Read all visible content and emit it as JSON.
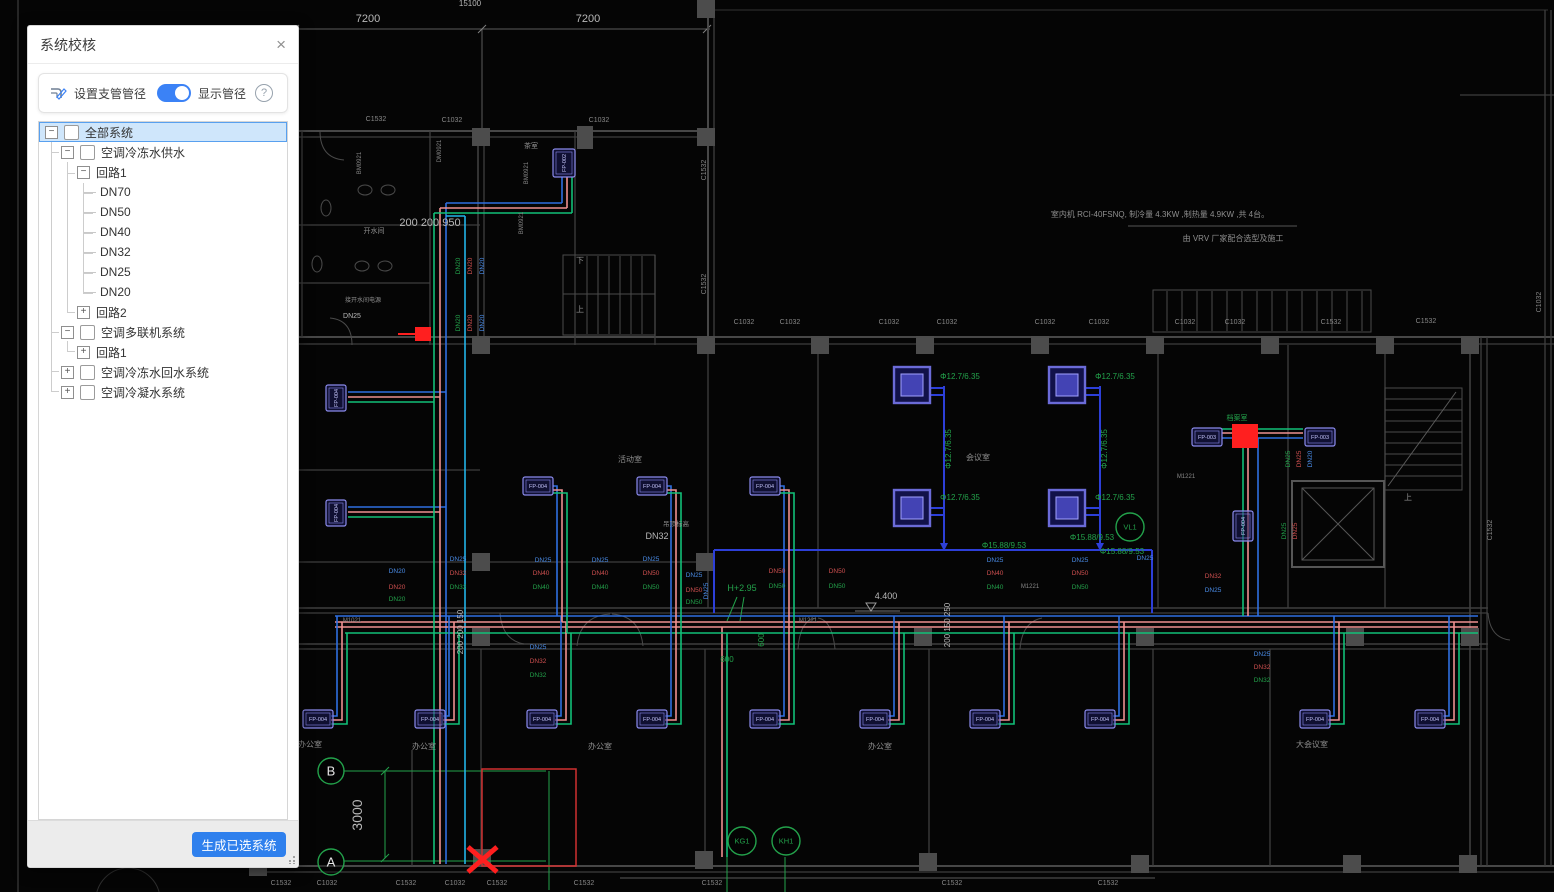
{
  "panel": {
    "title": "系统校核",
    "close_icon": "×",
    "toolbar": {
      "set_branch_icon": "pipe-pencil-icon",
      "set_branch_label": "设置支管管径",
      "toggle_on": true,
      "show_diameter_label": "显示管径",
      "help_icon": "?"
    },
    "tree": [
      {
        "label": "全部系统",
        "level": 0,
        "exp": "minus",
        "checkbox": true,
        "selected": true
      },
      {
        "label": "空调冷冻水供水",
        "level": 1,
        "exp": "minus",
        "checkbox": true
      },
      {
        "label": "回路1",
        "level": 2,
        "exp": "minus",
        "checkbox": false
      },
      {
        "label": "DN70",
        "level": 3
      },
      {
        "label": "DN50",
        "level": 3
      },
      {
        "label": "DN40",
        "level": 3
      },
      {
        "label": "DN32",
        "level": 3
      },
      {
        "label": "DN25",
        "level": 3
      },
      {
        "label": "DN20",
        "level": 3
      },
      {
        "label": "回路2",
        "level": 2,
        "exp": "plus",
        "checkbox": false
      },
      {
        "label": "空调多联机系统",
        "level": 1,
        "exp": "minus",
        "checkbox": true
      },
      {
        "label": "回路1",
        "level": 2,
        "exp": "plus",
        "checkbox": false
      },
      {
        "label": "空调冷冻水回水系统",
        "level": 1,
        "exp": "plus",
        "checkbox": true
      },
      {
        "label": "空调冷凝水系统",
        "level": 1,
        "exp": "plus",
        "checkbox": true
      }
    ],
    "generate_button": "生成已选系统"
  },
  "canvas": {
    "colors": {
      "dim": "#b8b8b8",
      "room": "#8f8f8f",
      "grid": "#878787",
      "grn": "#23a24b",
      "b": "#4a8ce8",
      "r": "#cf5050",
      "g": "#23a24b",
      "unit": "#8b8bec",
      "red": "#ff2020",
      "pipe_blue": "#2f6fe0",
      "pipe_cyan": "#22b3e8",
      "pipe_pink": "#ef9191",
      "pipe_green": "#12c078",
      "pipe_vrv": "#2d3fd8"
    },
    "labels": [
      {
        "t": "7200",
        "x": 368,
        "y": 22,
        "c": "dim",
        "s": 11
      },
      {
        "t": "7200",
        "x": 588,
        "y": 22,
        "c": "dim",
        "s": 11
      },
      {
        "t": "15100",
        "x": 470,
        "y": 6,
        "c": "dim",
        "s": 8
      },
      {
        "t": "3000",
        "x": 362,
        "y": 815,
        "c": "dim",
        "s": 14,
        "r": -90
      },
      {
        "t": "200 200 950",
        "x": 430,
        "y": 226,
        "c": "dim",
        "s": 11
      },
      {
        "t": "200 200 150",
        "x": 463,
        "y": 632,
        "c": "dim",
        "s": 8,
        "r": -90
      },
      {
        "t": "200 150 250",
        "x": 950,
        "y": 625,
        "c": "dim",
        "s": 8,
        "r": -90
      },
      {
        "t": "4.400",
        "x": 886,
        "y": 599,
        "c": "dim",
        "s": 9
      },
      {
        "t": "DN32",
        "x": 657,
        "y": 539,
        "c": "dim",
        "s": 9
      },
      {
        "t": "DN25",
        "x": 352,
        "y": 318,
        "c": "dim",
        "s": 7
      },
      {
        "t": "H+2.95",
        "x": 742,
        "y": 591,
        "c": "grn",
        "s": 9
      },
      {
        "t": "600",
        "x": 764,
        "y": 640,
        "c": "grn",
        "s": 8,
        "r": -90
      },
      {
        "t": "600",
        "x": 727,
        "y": 662,
        "c": "grn",
        "s": 8
      },
      {
        "t": "Φ12.7/6.35",
        "x": 960,
        "y": 379,
        "c": "grn",
        "s": 8
      },
      {
        "t": "Φ12.7/6.35",
        "x": 1115,
        "y": 379,
        "c": "grn",
        "s": 8
      },
      {
        "t": "Φ12.7/6.35",
        "x": 951,
        "y": 449,
        "c": "grn",
        "s": 8,
        "r": -90
      },
      {
        "t": "Φ12.7/6.35",
        "x": 1107,
        "y": 449,
        "c": "grn",
        "s": 8,
        "r": -90
      },
      {
        "t": "Φ12.7/6.35",
        "x": 960,
        "y": 500,
        "c": "grn",
        "s": 8
      },
      {
        "t": "Φ12.7/6.35",
        "x": 1115,
        "y": 500,
        "c": "grn",
        "s": 8
      },
      {
        "t": "Φ15.88/9.53",
        "x": 1004,
        "y": 548,
        "c": "grn",
        "s": 8
      },
      {
        "t": "Φ15.88/9.53",
        "x": 1092,
        "y": 540,
        "c": "grn",
        "s": 8
      },
      {
        "t": "Φ15.88/9.53",
        "x": 1122,
        "y": 554,
        "c": "grn",
        "s": 8
      },
      {
        "t": "室内机 RCI-40FSNQ,   制冷量 4.3KW   ,制热量 4.9KW   ,共 4台。",
        "x": 1160,
        "y": 217,
        "c": "room",
        "s": 8
      },
      {
        "t": "由 VRV  厂家配合选型及施工",
        "x": 1233,
        "y": 241,
        "c": "room",
        "s": 8
      },
      {
        "t": "办公室",
        "x": 310,
        "y": 747,
        "c": "room",
        "s": 8
      },
      {
        "t": "办公室",
        "x": 424,
        "y": 749,
        "c": "room",
        "s": 8
      },
      {
        "t": "办公室",
        "x": 600,
        "y": 749,
        "c": "room",
        "s": 8
      },
      {
        "t": "办公室",
        "x": 880,
        "y": 749,
        "c": "room",
        "s": 8
      },
      {
        "t": "大会议室",
        "x": 1312,
        "y": 747,
        "c": "room",
        "s": 8
      },
      {
        "t": "活动室",
        "x": 630,
        "y": 462,
        "c": "room",
        "s": 8
      },
      {
        "t": "会议室",
        "x": 978,
        "y": 460,
        "c": "room",
        "s": 8
      },
      {
        "t": "档案室",
        "x": 1237,
        "y": 420,
        "c": "grn",
        "s": 7
      },
      {
        "t": "开水间",
        "x": 374,
        "y": 233,
        "c": "room",
        "s": 7
      },
      {
        "t": "茶室",
        "x": 531,
        "y": 148,
        "c": "room",
        "s": 7
      },
      {
        "t": "接开水间电源",
        "x": 363,
        "y": 302,
        "c": "room",
        "s": 6
      },
      {
        "t": "吊顶标高",
        "x": 676,
        "y": 526,
        "c": "room",
        "s": 6.5
      },
      {
        "t": "上",
        "x": 580,
        "y": 312,
        "c": "room",
        "s": 8
      },
      {
        "t": "下",
        "x": 580,
        "y": 263,
        "c": "room",
        "s": 8
      },
      {
        "t": "上",
        "x": 1408,
        "y": 500,
        "c": "room",
        "s": 8
      },
      {
        "t": "C1532",
        "x": 376,
        "y": 121,
        "c": "grid",
        "s": 7
      },
      {
        "t": "C1032",
        "x": 452,
        "y": 122,
        "c": "grid",
        "s": 7
      },
      {
        "t": "C1032",
        "x": 599,
        "y": 122,
        "c": "grid",
        "s": 7
      },
      {
        "t": "C1032",
        "x": 744,
        "y": 324,
        "c": "grid",
        "s": 7
      },
      {
        "t": "C1032",
        "x": 790,
        "y": 324,
        "c": "grid",
        "s": 7
      },
      {
        "t": "C1032",
        "x": 889,
        "y": 324,
        "c": "grid",
        "s": 7
      },
      {
        "t": "C1032",
        "x": 947,
        "y": 324,
        "c": "grid",
        "s": 7
      },
      {
        "t": "C1032",
        "x": 1045,
        "y": 324,
        "c": "grid",
        "s": 7
      },
      {
        "t": "C1032",
        "x": 1099,
        "y": 324,
        "c": "grid",
        "s": 7
      },
      {
        "t": "C1032",
        "x": 1185,
        "y": 324,
        "c": "grid",
        "s": 7
      },
      {
        "t": "C1032",
        "x": 1235,
        "y": 324,
        "c": "grid",
        "s": 7
      },
      {
        "t": "C1532",
        "x": 1331,
        "y": 324,
        "c": "grid",
        "s": 7
      },
      {
        "t": "C1532",
        "x": 1426,
        "y": 323,
        "c": "grid",
        "s": 7
      },
      {
        "t": "C1532",
        "x": 281,
        "y": 885,
        "c": "grid",
        "s": 7
      },
      {
        "t": "C1032",
        "x": 327,
        "y": 885,
        "c": "grid",
        "s": 7
      },
      {
        "t": "C1532",
        "x": 406,
        "y": 885,
        "c": "grid",
        "s": 7
      },
      {
        "t": "C1032",
        "x": 455,
        "y": 885,
        "c": "grid",
        "s": 7
      },
      {
        "t": "C1532",
        "x": 497,
        "y": 885,
        "c": "grid",
        "s": 7
      },
      {
        "t": "C1532",
        "x": 584,
        "y": 885,
        "c": "grid",
        "s": 7
      },
      {
        "t": "C1532",
        "x": 712,
        "y": 885,
        "c": "grid",
        "s": 7
      },
      {
        "t": "C1532",
        "x": 952,
        "y": 885,
        "c": "grid",
        "s": 7
      },
      {
        "t": "C1532",
        "x": 1108,
        "y": 885,
        "c": "grid",
        "s": 7
      },
      {
        "t": "C1532",
        "x": 706,
        "y": 170,
        "c": "grid",
        "s": 7,
        "r": -90
      },
      {
        "t": "C1532",
        "x": 706,
        "y": 284,
        "c": "grid",
        "s": 7,
        "r": -90
      },
      {
        "t": "C1532",
        "x": 1492,
        "y": 530,
        "c": "grid",
        "s": 7,
        "r": -90
      },
      {
        "t": "C1032",
        "x": 1541,
        "y": 302,
        "c": "grid",
        "s": 7,
        "r": -90
      },
      {
        "t": "BM0921",
        "x": 361,
        "y": 163,
        "c": "grid",
        "s": 6,
        "r": -90
      },
      {
        "t": "DM0921",
        "x": 441,
        "y": 151,
        "c": "grid",
        "s": 6,
        "r": -90
      },
      {
        "t": "BM0921",
        "x": 528,
        "y": 173,
        "c": "grid",
        "s": 6,
        "r": -90
      },
      {
        "t": "BM0921",
        "x": 523,
        "y": 223,
        "c": "grid",
        "s": 6,
        "r": -90
      },
      {
        "t": "M1021",
        "x": 352,
        "y": 622,
        "c": "grid",
        "s": 6
      },
      {
        "t": "M1221",
        "x": 808,
        "y": 622,
        "c": "grid",
        "s": 6
      },
      {
        "t": "M1221",
        "x": 1030,
        "y": 588,
        "c": "grid",
        "s": 6
      },
      {
        "t": "M1221",
        "x": 1186,
        "y": 478,
        "c": "grid",
        "s": 6
      },
      {
        "t": "DN20",
        "x": 397,
        "y": 573,
        "c": "b",
        "s": 6.5
      },
      {
        "t": "DN20",
        "x": 397,
        "y": 589,
        "c": "r",
        "s": 6.5
      },
      {
        "t": "DN20",
        "x": 397,
        "y": 601,
        "c": "g",
        "s": 6.5
      },
      {
        "t": "DN25",
        "x": 458,
        "y": 561,
        "c": "b",
        "s": 6.5
      },
      {
        "t": "DN32",
        "x": 458,
        "y": 575,
        "c": "r",
        "s": 6.5
      },
      {
        "t": "DN32",
        "x": 458,
        "y": 589,
        "c": "g",
        "s": 6.5
      },
      {
        "t": "DN25",
        "x": 543,
        "y": 562,
        "c": "b",
        "s": 6.5
      },
      {
        "t": "DN40",
        "x": 541,
        "y": 575,
        "c": "r",
        "s": 6.5
      },
      {
        "t": "DN40",
        "x": 541,
        "y": 589,
        "c": "g",
        "s": 6.5
      },
      {
        "t": "DN25",
        "x": 600,
        "y": 562,
        "c": "b",
        "s": 6.5
      },
      {
        "t": "DN40",
        "x": 600,
        "y": 575,
        "c": "r",
        "s": 6.5
      },
      {
        "t": "DN40",
        "x": 600,
        "y": 589,
        "c": "g",
        "s": 6.5
      },
      {
        "t": "DN25",
        "x": 651,
        "y": 561,
        "c": "b",
        "s": 6.5
      },
      {
        "t": "DN50",
        "x": 651,
        "y": 575,
        "c": "r",
        "s": 6.5
      },
      {
        "t": "DN50",
        "x": 651,
        "y": 589,
        "c": "g",
        "s": 6.5
      },
      {
        "t": "DN25",
        "x": 694,
        "y": 577,
        "c": "b",
        "s": 6.5
      },
      {
        "t": "DN50",
        "x": 694,
        "y": 592,
        "c": "r",
        "s": 6.5
      },
      {
        "t": "DN50",
        "x": 694,
        "y": 604,
        "c": "g",
        "s": 6.5
      },
      {
        "t": "DN50",
        "x": 777,
        "y": 573,
        "c": "r",
        "s": 6.5
      },
      {
        "t": "DN50",
        "x": 777,
        "y": 588,
        "c": "g",
        "s": 6.5
      },
      {
        "t": "DN50",
        "x": 837,
        "y": 573,
        "c": "r",
        "s": 6.5
      },
      {
        "t": "DN50",
        "x": 837,
        "y": 588,
        "c": "g",
        "s": 6.5
      },
      {
        "t": "DN25",
        "x": 995,
        "y": 562,
        "c": "b",
        "s": 6.5
      },
      {
        "t": "DN40",
        "x": 995,
        "y": 575,
        "c": "r",
        "s": 6.5
      },
      {
        "t": "DN40",
        "x": 995,
        "y": 589,
        "c": "g",
        "s": 6.5
      },
      {
        "t": "DN25",
        "x": 1080,
        "y": 562,
        "c": "b",
        "s": 6.5
      },
      {
        "t": "DN50",
        "x": 1080,
        "y": 575,
        "c": "r",
        "s": 6.5
      },
      {
        "t": "DN50",
        "x": 1080,
        "y": 589,
        "c": "g",
        "s": 6.5
      },
      {
        "t": "DN25",
        "x": 1145,
        "y": 560,
        "c": "b",
        "s": 6.5
      },
      {
        "t": "DN32",
        "x": 1213,
        "y": 578,
        "c": "r",
        "s": 6.5
      },
      {
        "t": "DN25",
        "x": 1213,
        "y": 592,
        "c": "b",
        "s": 6.5
      },
      {
        "t": "DN25",
        "x": 538,
        "y": 649,
        "c": "b",
        "s": 6.5
      },
      {
        "t": "DN32",
        "x": 538,
        "y": 663,
        "c": "r",
        "s": 6.5
      },
      {
        "t": "DN32",
        "x": 538,
        "y": 677,
        "c": "g",
        "s": 6.5
      },
      {
        "t": "DN25",
        "x": 1262,
        "y": 656,
        "c": "b",
        "s": 6.5
      },
      {
        "t": "DN32",
        "x": 1262,
        "y": 669,
        "c": "r",
        "s": 6.5
      },
      {
        "t": "DN32",
        "x": 1262,
        "y": 682,
        "c": "g",
        "s": 6.5
      },
      {
        "t": "DN20",
        "x": 460,
        "y": 266,
        "c": "g",
        "s": 6.5,
        "r": -90
      },
      {
        "t": "DN20",
        "x": 472,
        "y": 266,
        "c": "r",
        "s": 6.5,
        "r": -90
      },
      {
        "t": "DN20",
        "x": 484,
        "y": 266,
        "c": "b",
        "s": 6.5,
        "r": -90
      },
      {
        "t": "DN20",
        "x": 460,
        "y": 323,
        "c": "g",
        "s": 6.5,
        "r": -90
      },
      {
        "t": "DN20",
        "x": 472,
        "y": 323,
        "c": "r",
        "s": 6.5,
        "r": -90
      },
      {
        "t": "DN20",
        "x": 484,
        "y": 323,
        "c": "b",
        "s": 6.5,
        "r": -90
      },
      {
        "t": "DN25",
        "x": 1290,
        "y": 459,
        "c": "g",
        "s": 6.5,
        "r": -90
      },
      {
        "t": "DN25",
        "x": 1301,
        "y": 459,
        "c": "r",
        "s": 6.5,
        "r": -90
      },
      {
        "t": "DN20",
        "x": 1312,
        "y": 459,
        "c": "b",
        "s": 6.5,
        "r": -90
      },
      {
        "t": "DN25",
        "x": 1286,
        "y": 531,
        "c": "g",
        "s": 6.5,
        "r": -90
      },
      {
        "t": "DN25",
        "x": 1297,
        "y": 531,
        "c": "r",
        "s": 6.5,
        "r": -90
      },
      {
        "t": "DN25",
        "x": 708,
        "y": 591,
        "c": "b",
        "s": 6.5,
        "r": -90
      }
    ],
    "units": [
      {
        "label": "FP-004",
        "x": 303,
        "y": 710,
        "w": 30,
        "h": 18
      },
      {
        "label": "FP-004",
        "x": 415,
        "y": 710,
        "w": 30,
        "h": 18
      },
      {
        "label": "FP-004",
        "x": 527,
        "y": 710,
        "w": 30,
        "h": 18
      },
      {
        "label": "FP-004",
        "x": 637,
        "y": 710,
        "w": 30,
        "h": 18
      },
      {
        "label": "FP-004",
        "x": 750,
        "y": 710,
        "w": 30,
        "h": 18
      },
      {
        "label": "FP-004",
        "x": 860,
        "y": 710,
        "w": 30,
        "h": 18
      },
      {
        "label": "FP-004",
        "x": 970,
        "y": 710,
        "w": 30,
        "h": 18
      },
      {
        "label": "FP-004",
        "x": 1085,
        "y": 710,
        "w": 30,
        "h": 18
      },
      {
        "label": "FP-004",
        "x": 1300,
        "y": 710,
        "w": 30,
        "h": 18
      },
      {
        "label": "FP-004",
        "x": 1415,
        "y": 710,
        "w": 30,
        "h": 18
      },
      {
        "label": "FP-004",
        "x": 523,
        "y": 477,
        "w": 30,
        "h": 18
      },
      {
        "label": "FP-004",
        "x": 637,
        "y": 477,
        "w": 30,
        "h": 18
      },
      {
        "label": "FP-004",
        "x": 750,
        "y": 477,
        "w": 30,
        "h": 18
      },
      {
        "label": "FP-004",
        "x": 326,
        "y": 385,
        "w": 20,
        "h": 26,
        "rot": 1
      },
      {
        "label": "FP-004",
        "x": 326,
        "y": 500,
        "w": 20,
        "h": 26,
        "rot": 1
      },
      {
        "label": "FP-002",
        "x": 553,
        "y": 149,
        "w": 22,
        "h": 28,
        "rot": 1
      },
      {
        "label": "FP-003",
        "x": 1192,
        "y": 428,
        "w": 30,
        "h": 18
      },
      {
        "label": "FP-003",
        "x": 1305,
        "y": 428,
        "w": 30,
        "h": 18
      },
      {
        "label": "FP-004",
        "x": 1233,
        "y": 511,
        "w": 20,
        "h": 30,
        "rot": 1
      }
    ],
    "cassettes": [
      [
        894,
        367
      ],
      [
        1049,
        367
      ],
      [
        894,
        490
      ],
      [
        1049,
        490
      ]
    ],
    "circles": [
      {
        "name": "grid-bubble-b",
        "label": "B",
        "x": 331,
        "y": 771,
        "r": 13,
        "fs": 13,
        "white": true
      },
      {
        "name": "grid-bubble-a",
        "label": "A",
        "x": 331,
        "y": 862,
        "r": 13,
        "fs": 13,
        "white": true
      },
      {
        "name": "tag-kg1",
        "label": "KG1",
        "x": 742,
        "y": 841,
        "r": 14,
        "fs": 7.5
      },
      {
        "name": "tag-kh1",
        "label": "KH1",
        "x": 786,
        "y": 841,
        "r": 14,
        "fs": 7.5
      },
      {
        "name": "tag-vl1",
        "label": "VL1",
        "x": 1130,
        "y": 527,
        "r": 14,
        "fs": 7.5
      }
    ]
  }
}
